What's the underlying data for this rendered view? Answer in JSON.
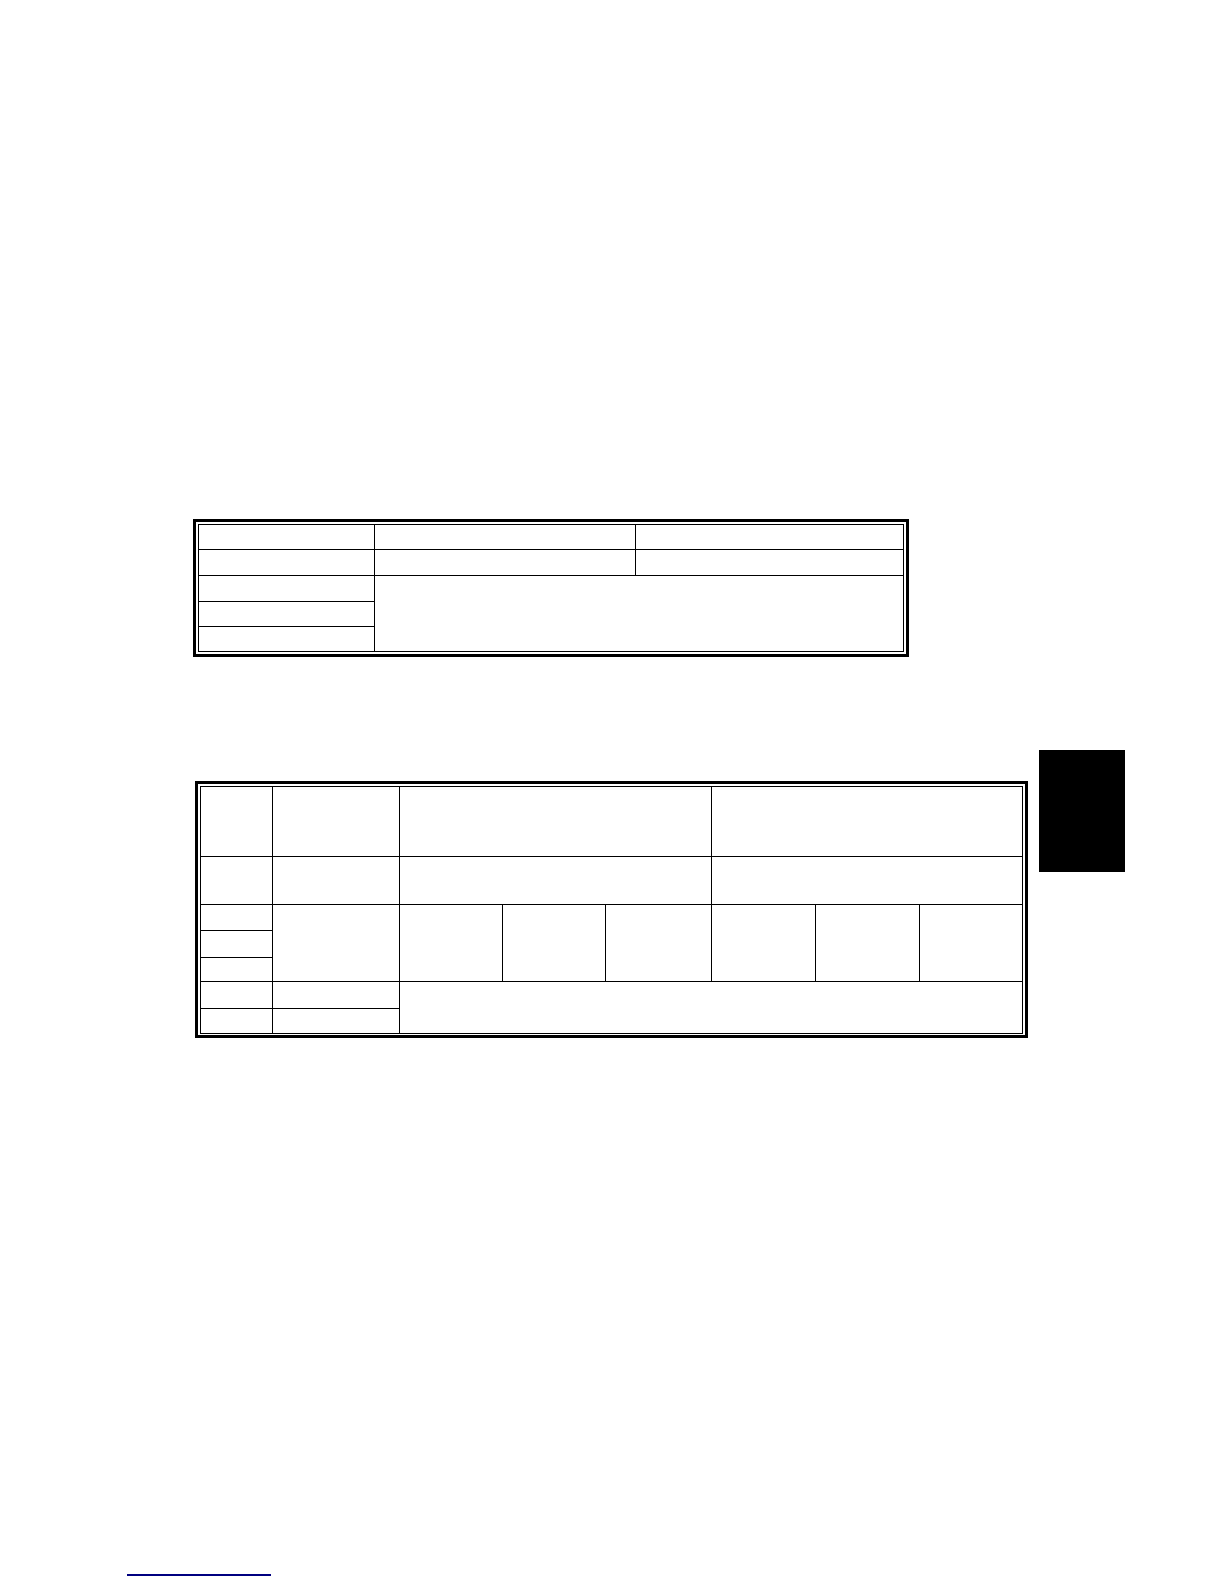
{
  "page": {
    "background_color": "#ffffff",
    "width_px": 1224,
    "height_px": 1584
  },
  "upper_table": {
    "rows": 5,
    "columns": 3,
    "border_color": "#000000",
    "border_style": "double-box",
    "merged_region": "columns 2-3 merged across rows 3-5",
    "cells_text": ""
  },
  "lower_table": {
    "header_rows": 2,
    "sub_columns": 6,
    "first_column_splits": 3,
    "border_color": "#000000",
    "border_style": "double-box",
    "merged_region": "columns 3-8 merged across bottom two rows",
    "cells_text": ""
  },
  "edge_tab": {
    "color": "#000000"
  },
  "footer_link": {
    "label": "",
    "underline_color": "#000080"
  }
}
